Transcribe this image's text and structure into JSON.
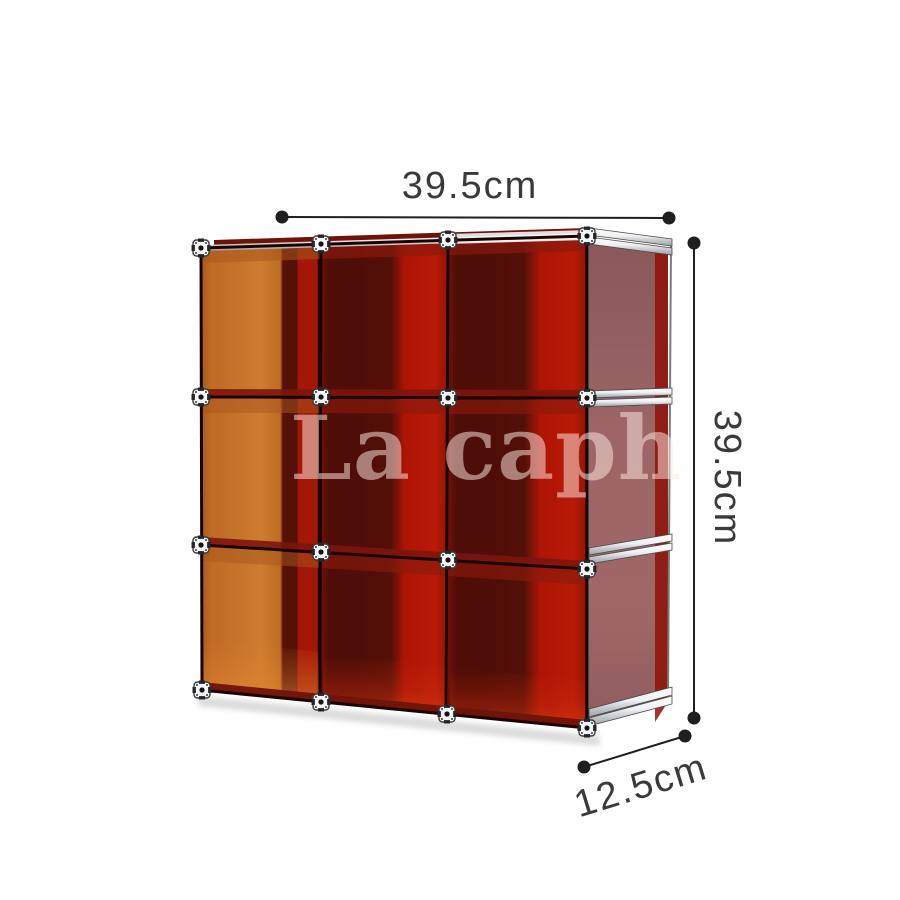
{
  "page": {
    "background": "#ffffff"
  },
  "watermark": {
    "text": "La caph",
    "color": "rgba(255,232,226,0.52)"
  },
  "dimensions": {
    "width": {
      "label": "39.5cm"
    },
    "height": {
      "label": "39.5cm"
    },
    "depth": {
      "label": "12.5cm"
    },
    "line_color": "#1f1f1f",
    "text_color": "#3a3a3a"
  },
  "shelf": {
    "rows": 3,
    "columns": 3,
    "colors": {
      "left_panel_orange": "#cd7c30",
      "acrylic_red_bright": "#b01505",
      "acrylic_red_dark": "#4e0d07",
      "side_panel_mauve": "#9c6566",
      "frame_aluminum": "#eef0f2",
      "edge_dark": "#1a0403"
    }
  }
}
